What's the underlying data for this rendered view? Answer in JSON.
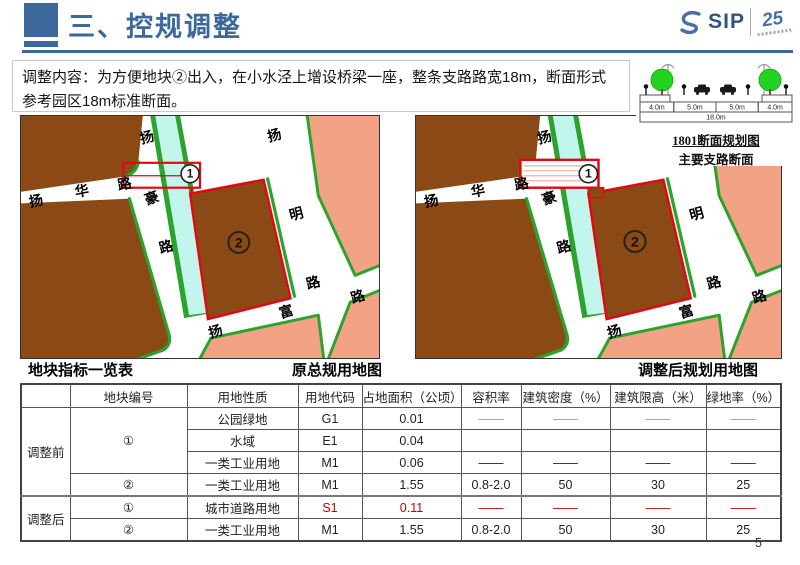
{
  "colors": {
    "accent": "#3d689c",
    "brown": "#8b4a15",
    "pink": "#f2a285",
    "stream": "#c2f6ec",
    "green": "#2ca32c",
    "red": "#e30613"
  },
  "header": {
    "title": "三、控规调整"
  },
  "logo": {
    "name": "SIP",
    "anniversary": "25"
  },
  "intro": {
    "text": "调整内容：为方便地块②出入，在小水泾上增设桥梁一座，整条支路路宽18m，断面形式参考园区18m标准断面。"
  },
  "section_diagram": {
    "dims": [
      "4.0m",
      "5.0m",
      "5.0m",
      "4.0m"
    ],
    "total": "18.0m",
    "title": "1801断面规划图",
    "subtitle": "主要支路断面"
  },
  "captions": {
    "indicator_table": "地块指标一览表",
    "original_map": "原总规用地图",
    "adjusted_map": "调整后规划用地图"
  },
  "maps": {
    "left": {
      "plot1": "1",
      "plot2": "2",
      "labels": [
        {
          "t": "扬",
          "x": 128,
          "y": 26,
          "r": -15
        },
        {
          "t": "豪",
          "x": 133,
          "y": 87,
          "r": -20
        },
        {
          "t": "路",
          "x": 147,
          "y": 136,
          "r": -15
        },
        {
          "t": "扬",
          "x": 16,
          "y": 90,
          "r": -11
        },
        {
          "t": "华",
          "x": 62,
          "y": 80,
          "r": -11
        },
        {
          "t": "路",
          "x": 105,
          "y": 73,
          "r": -11
        },
        {
          "t": "扬",
          "x": 256,
          "y": 24,
          "r": -15
        },
        {
          "t": "明",
          "x": 278,
          "y": 103,
          "r": -15
        },
        {
          "t": "路",
          "x": 295,
          "y": 172,
          "r": -15
        },
        {
          "t": "扬",
          "x": 197,
          "y": 221,
          "r": -17
        },
        {
          "t": "富",
          "x": 268,
          "y": 201,
          "r": -17
        },
        {
          "t": "路",
          "x": 340,
          "y": 186,
          "r": -17
        }
      ]
    },
    "right": {
      "plot1": "1",
      "plot2": "2",
      "labels": [
        {
          "t": "扬",
          "x": 128,
          "y": 26,
          "r": -15
        },
        {
          "t": "豪",
          "x": 133,
          "y": 87,
          "r": -20
        },
        {
          "t": "路",
          "x": 147,
          "y": 136,
          "r": -15
        },
        {
          "t": "扬",
          "x": 16,
          "y": 90,
          "r": -11
        },
        {
          "t": "华",
          "x": 62,
          "y": 80,
          "r": -11
        },
        {
          "t": "路",
          "x": 105,
          "y": 73,
          "r": -11
        },
        {
          "t": "扬",
          "x": 256,
          "y": 24,
          "r": -15
        },
        {
          "t": "明",
          "x": 278,
          "y": 103,
          "r": -15
        },
        {
          "t": "路",
          "x": 295,
          "y": 172,
          "r": -15
        },
        {
          "t": "扬",
          "x": 197,
          "y": 221,
          "r": -17
        },
        {
          "t": "富",
          "x": 268,
          "y": 201,
          "r": -17
        },
        {
          "t": "路",
          "x": 340,
          "y": 186,
          "r": -17
        }
      ]
    }
  },
  "table": {
    "headers": [
      "",
      "地块编号",
      "用地性质",
      "用地代码",
      "占地面积（公顷）",
      "容积率",
      "建筑密度（%）",
      "建筑限高（米）",
      "绿地率（%）"
    ],
    "group1": "调整前",
    "group2": "调整后",
    "rows": [
      {
        "plot": "①",
        "use": "公园绿地",
        "code": "G1",
        "area": "0.01",
        "far": "——",
        "density": "——",
        "height": "——",
        "green": "——"
      },
      {
        "plot": "",
        "use": "水域",
        "code": "E1",
        "area": "0.04",
        "far": "",
        "density": "",
        "height": "",
        "green": ""
      },
      {
        "plot": "",
        "use": "一类工业用地",
        "code": "M1",
        "area": "0.06",
        "far": "——",
        "density": "——",
        "height": "——",
        "green": "——"
      },
      {
        "plot": "②",
        "use": "一类工业用地",
        "code": "M1",
        "area": "1.55",
        "far": "0.8-2.0",
        "density": "50",
        "height": "30",
        "green": "25"
      },
      {
        "plot": "①",
        "use": "城市道路用地",
        "code": "S1",
        "area": "0.11",
        "far": "——",
        "density": "——",
        "height": "——",
        "green": "——"
      },
      {
        "plot": "②",
        "use": "一类工业用地",
        "code": "M1",
        "area": "1.55",
        "far": "0.8-2.0",
        "density": "50",
        "height": "30",
        "green": "25"
      }
    ]
  },
  "page": {
    "number": "5"
  }
}
